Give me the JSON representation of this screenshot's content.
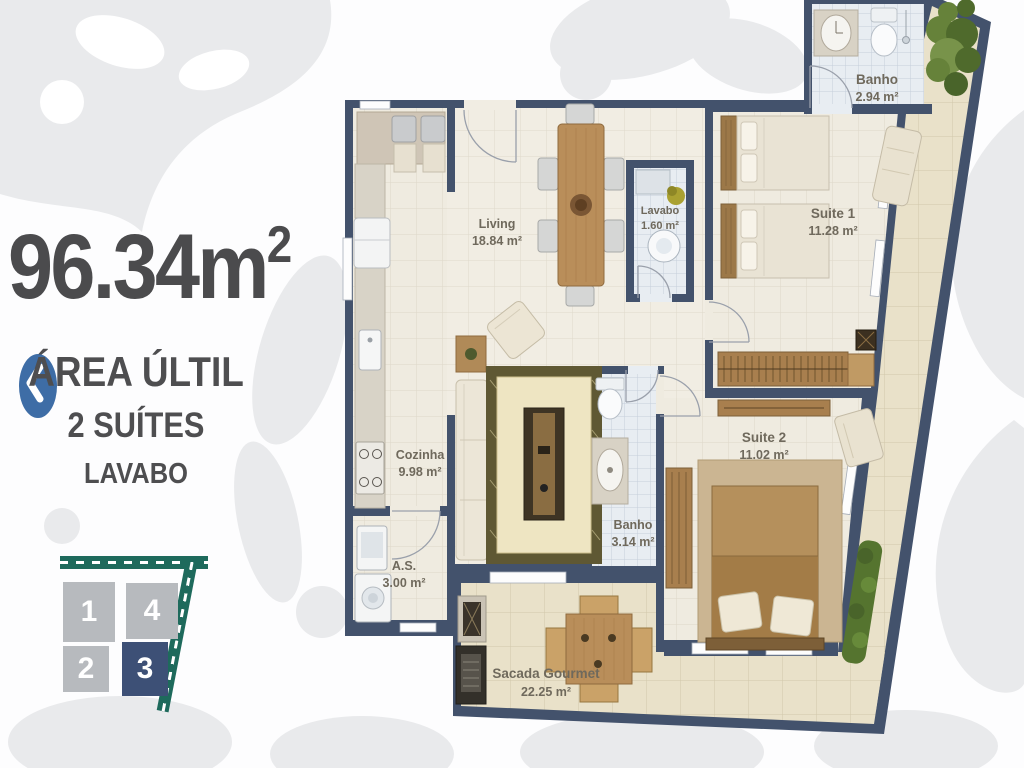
{
  "panel": {
    "area_value": "96.34m",
    "area_sup": "2",
    "subtitle1": "ÁREA ÚLTIL",
    "subtitle2": "2 SUÍTES",
    "subtitle3": "LAVABO"
  },
  "unit_selector": {
    "units": [
      {
        "label": "1",
        "active": false
      },
      {
        "label": "2",
        "active": false
      },
      {
        "label": "3",
        "active": true
      },
      {
        "label": "4",
        "active": false
      }
    ],
    "active_color": "#3d5076",
    "inactive_color": "#b7babe",
    "road_color": "#1e6a5c"
  },
  "plan": {
    "wall_color": "#43526c",
    "rooms": [
      {
        "id": "living",
        "name": "Living",
        "area": "18.84 m²"
      },
      {
        "id": "lavabo",
        "name": "Lavabo",
        "area": "1.60 m²"
      },
      {
        "id": "suite-1",
        "name": "Suite 1",
        "area": "11.28 m²"
      },
      {
        "id": "banho-suite-1",
        "name": "Banho",
        "area": "2.94 m²"
      },
      {
        "id": "cozinha",
        "name": "Cozinha",
        "area": "9.98 m²"
      },
      {
        "id": "suite-2",
        "name": "Suite 2",
        "area": "11.02 m²"
      },
      {
        "id": "banho-suite-2",
        "name": "Banho",
        "area": "3.14 m²"
      },
      {
        "id": "area-servico",
        "name": "A.S.",
        "area": "3.00 m²"
      },
      {
        "id": "sacada-gourmet",
        "name": "Sacada Gourmet",
        "area": "22.25 m²"
      }
    ]
  },
  "colors": {
    "accent_button": "#3e6da6",
    "title_text": "#4b4b4d",
    "floor_cream": "#efebe0",
    "floor_bath": "#e8edf2",
    "floor_balcony": "#e9e1c9"
  }
}
